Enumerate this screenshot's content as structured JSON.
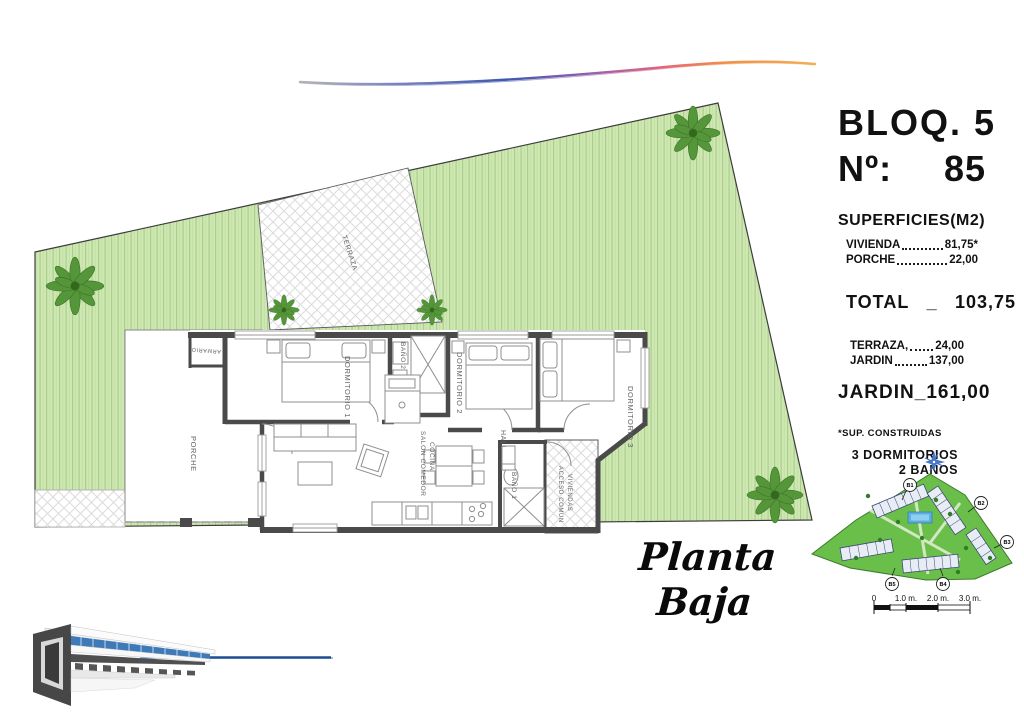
{
  "header": {
    "block": "BLOQ. 5",
    "unit_label": "Nº:",
    "unit_number": "85"
  },
  "surfaces": {
    "title": "SUPERFICIES(M2)",
    "rows_built": [
      {
        "label": "VIVIENDA",
        "value": "81,75*"
      },
      {
        "label": "PORCHE",
        "value": "22,00"
      }
    ],
    "total_label": "TOTAL",
    "total_sep": "_",
    "total_value": "103,75",
    "rows_outdoor": [
      {
        "label": "TERRAZA,",
        "value": "24,00"
      },
      {
        "label": "JARDIN",
        "value": "137,00"
      }
    ],
    "garden_label": "JARDIN",
    "garden_sep": "_",
    "garden_value": "161,00",
    "footnote": "*SUP. CONSTRUIDAS",
    "bedrooms": "3 DORMITORIOS",
    "bathrooms": "2 BAÑOS"
  },
  "plan": {
    "title": "Planta Baja",
    "rooms": {
      "terraza": "TERRAZA",
      "armario": "ARMARIO",
      "dorm1": "DORMITORIO 1",
      "bano2": "BAÑO 2",
      "dorm2": "DORMITORIO 2",
      "dorm3": "DORMITORIO 3",
      "hall": "HALL",
      "salon_line1": "SALON COMEDOR",
      "salon_line2": "COCINA",
      "porche": "PORCHE",
      "bano1": "BAÑO 1",
      "acceso_line1": "ACCESO COMUN",
      "acceso_line2": "VIVIENDAS"
    }
  },
  "scale_bar": {
    "tick0": "0",
    "tick1": "1.0 m.",
    "tick2": "2.0 m.",
    "tick3": "3.0 m."
  },
  "site_map": {
    "markers": [
      "B1",
      "B2",
      "B3",
      "B4",
      "B5"
    ]
  },
  "colors": {
    "garden": "#cfe7b3",
    "garden_stripe": "#a9d089",
    "tree": "#55963a",
    "wall": "#4a4a4a",
    "accent_blue": "#2e6cb0",
    "swoosh_orange": "#f0a040"
  }
}
